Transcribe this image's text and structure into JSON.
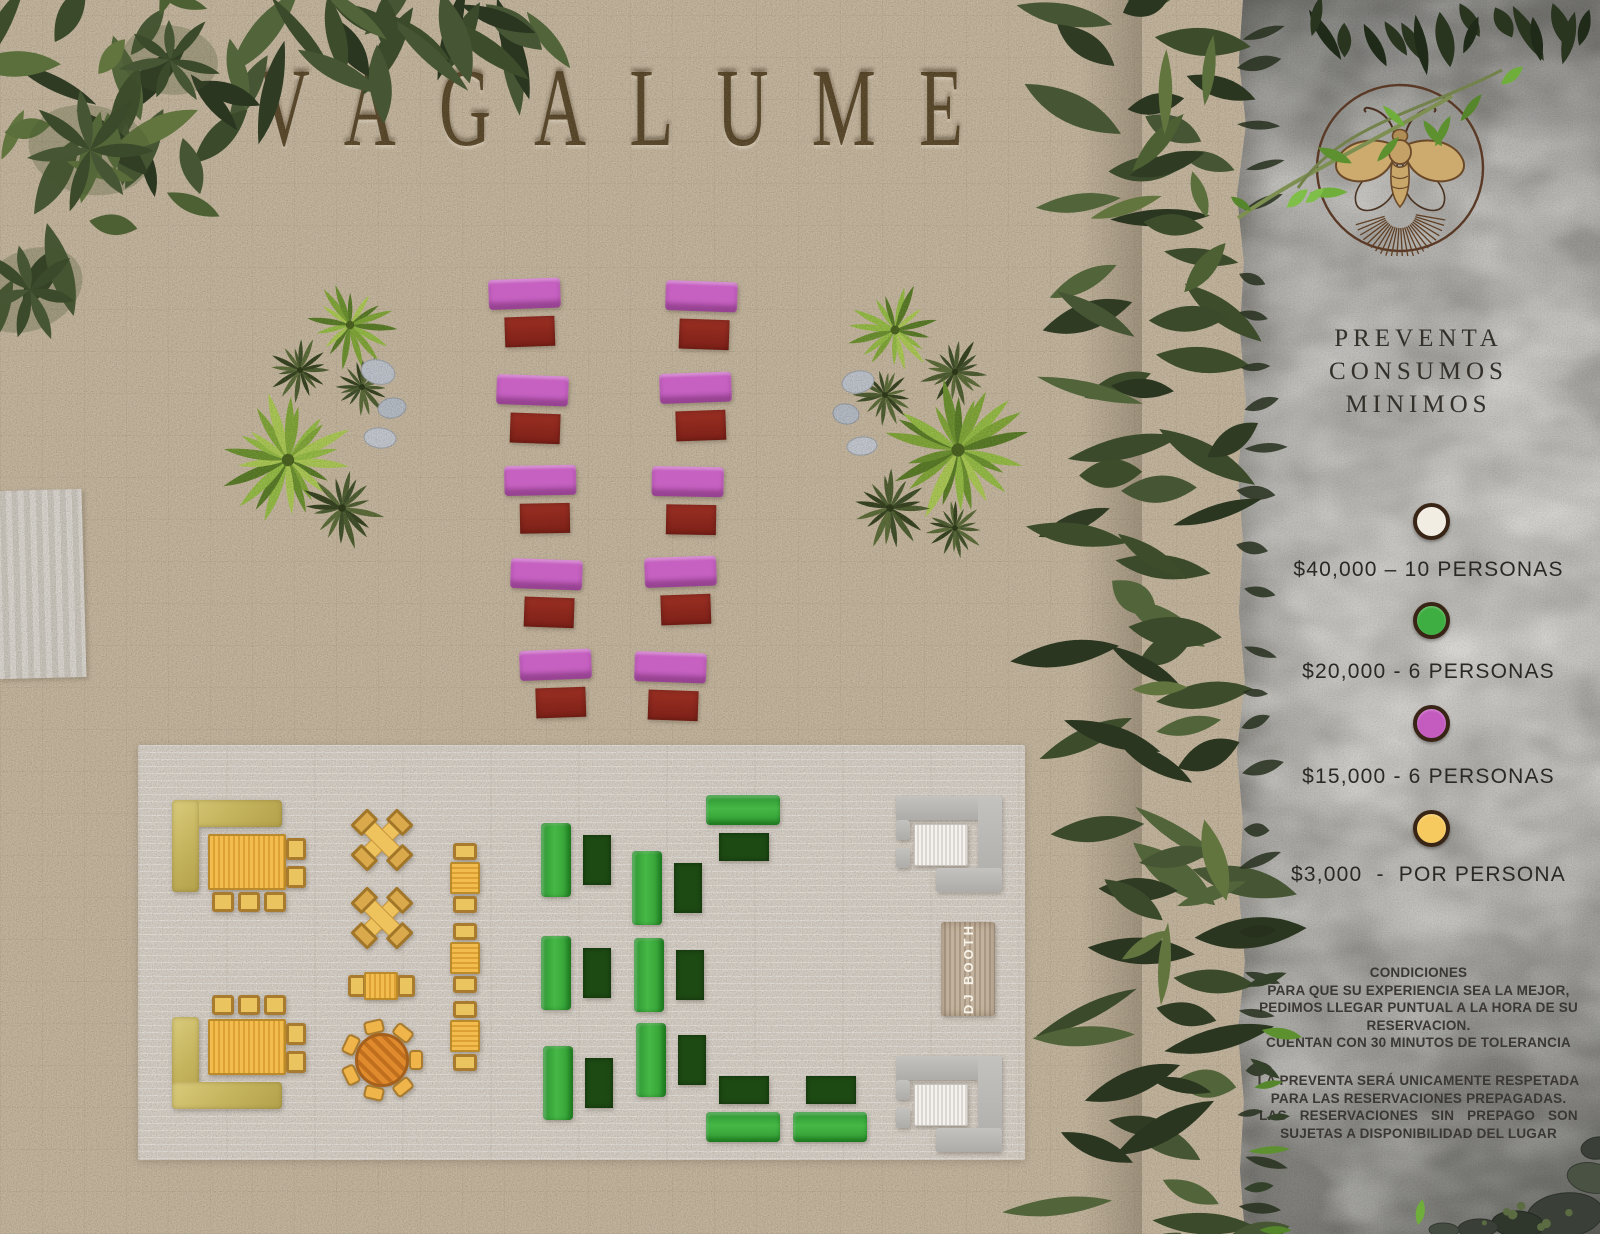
{
  "title": "VAGALUME",
  "panel": {
    "heading_lines": [
      "PREVENTA",
      "CONSUMOS",
      "MINIMOS"
    ],
    "legend": [
      {
        "name": "white",
        "color": "#f2ede3",
        "label": "$40,000 – 10 PERSONAS"
      },
      {
        "name": "green",
        "color": "#3fae42",
        "label": "$20,000 - 6 PERSONAS"
      },
      {
        "name": "magenta",
        "color": "#c45cc0",
        "label": "$15,000 - 6 PERSONAS"
      },
      {
        "name": "yellow",
        "color": "#f6ca5f",
        "label": "$3,000  -  POR PERSONA"
      }
    ],
    "conditions": {
      "title": "CONDICIONES",
      "lines": [
        "PARA QUE SU EXPERIENCIA SEA LA MEJOR,",
        "PEDIMOS LLEGAR PUNTUAL A LA HORA DE SU",
        "RESERVACION.",
        "CUENTAN CON 30 MINUTOS DE TOLERANCIA"
      ]
    },
    "presale_note": {
      "lines": [
        "LA PREVENTA SERÁ UNICAMENTE RESPETADA",
        "PARA LAS RESERVACIONES PREPAGADAS.",
        "LAS RESERVACIONES SIN PREPAGO SON",
        "SUJETAS A DISPONIBILIDAD DEL LUGAR"
      ]
    }
  },
  "map": {
    "dj_booth_label": "DJ BOOTH",
    "furniture": [
      {
        "type": "magenta_pair",
        "x": 488,
        "y": 280,
        "rot": -2
      },
      {
        "type": "magenta_pair",
        "x": 497,
        "y": 374,
        "rot": 2
      },
      {
        "type": "magenta_pair",
        "x": 504,
        "y": 466,
        "rot": -1
      },
      {
        "type": "magenta_pair",
        "x": 511,
        "y": 558,
        "rot": 2
      },
      {
        "type": "magenta_pair",
        "x": 519,
        "y": 651,
        "rot": -2
      },
      {
        "type": "magenta_pair",
        "x": 666,
        "y": 280,
        "rot": 2
      },
      {
        "type": "magenta_pair",
        "x": 659,
        "y": 374,
        "rot": -2
      },
      {
        "type": "magenta_pair",
        "x": 652,
        "y": 466,
        "rot": 1
      },
      {
        "type": "magenta_pair",
        "x": 644,
        "y": 558,
        "rot": -2
      },
      {
        "type": "magenta_pair",
        "x": 635,
        "y": 651,
        "rot": 2
      },
      {
        "type": "l_lounge_top",
        "x": 172,
        "y": 800
      },
      {
        "type": "l_lounge_bottom",
        "x": 172,
        "y": 995
      },
      {
        "type": "x_table",
        "x": 350,
        "y": 808
      },
      {
        "type": "x_table",
        "x": 350,
        "y": 886
      },
      {
        "type": "table_2_h",
        "x": 348,
        "y": 972
      },
      {
        "type": "round_table",
        "x": 340,
        "y": 1018
      },
      {
        "type": "table_2_v",
        "x": 450,
        "y": 843
      },
      {
        "type": "table_2_v",
        "x": 450,
        "y": 923
      },
      {
        "type": "table_2_v",
        "x": 450,
        "y": 1001
      },
      {
        "type": "green_group_v",
        "x": 541,
        "y": 823
      },
      {
        "type": "green_group_v",
        "x": 541,
        "y": 936
      },
      {
        "type": "green_group_v",
        "x": 543,
        "y": 1046
      },
      {
        "type": "green_group_v",
        "x": 632,
        "y": 851
      },
      {
        "type": "green_group_v",
        "x": 634,
        "y": 938
      },
      {
        "type": "green_group_v",
        "x": 636,
        "y": 1023
      },
      {
        "type": "green_group_h_down",
        "x": 706,
        "y": 795
      },
      {
        "type": "green_group_h_up",
        "x": 706,
        "y": 1076
      },
      {
        "type": "green_group_h_up",
        "x": 793,
        "y": 1076
      },
      {
        "type": "gray_lounge",
        "x": 896,
        "y": 796
      },
      {
        "type": "gray_lounge",
        "x": 896,
        "y": 1056
      },
      {
        "type": "dj_booth",
        "x": 941,
        "y": 922
      }
    ]
  },
  "colors": {
    "sand": "#c3b49c",
    "deck": "#d5cec5",
    "stone": "#aaa8a5",
    "title_brown": "#524022",
    "magenta_sofa": "#c661c1",
    "dark_red_table": "#8c2a1e",
    "green_sofa": "#3aa43c",
    "dark_green_table": "#1d4a13",
    "gold_table": "#ecbf4f",
    "olive_sofa": "#c6b55f",
    "orange_table": "#d9832c",
    "gray_sofa": "#b8b7b4",
    "white_table": "#efede8",
    "legend_ring": "#392516",
    "panel_text": "#2b2926",
    "foliage_dark": "#33412a",
    "logo_brown": "#5a3a26"
  }
}
